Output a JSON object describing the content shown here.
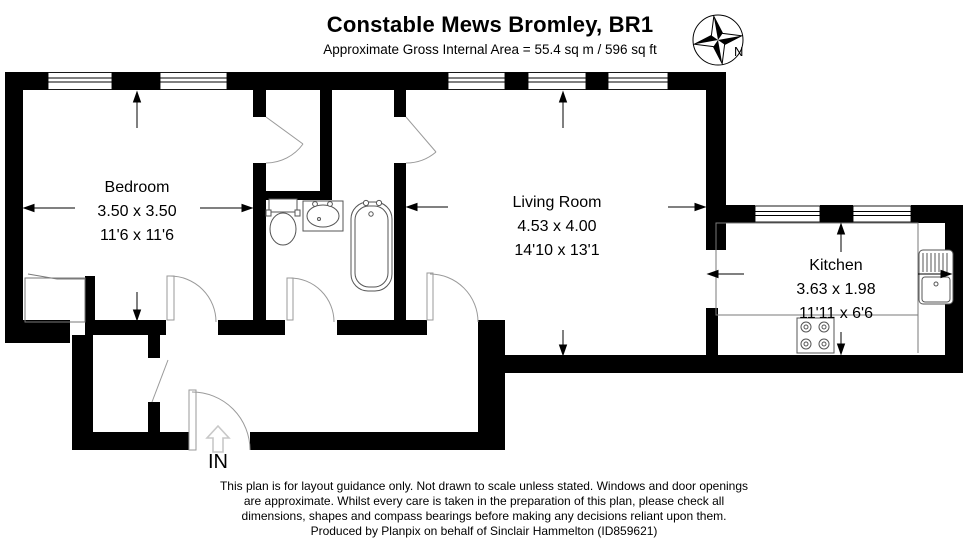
{
  "header": {
    "title": "Constable Mews Bromley, BR1",
    "subtitle": "Approximate Gross Internal Area = 55.4 sq m / 596 sq ft"
  },
  "compass": {
    "label": "N"
  },
  "entrance": {
    "label": "IN"
  },
  "rooms": {
    "bedroom": {
      "name": "Bedroom",
      "metric": "3.50 x 3.50",
      "imperial": "11'6 x 11'6"
    },
    "living_room": {
      "name": "Living Room",
      "metric": "4.53 x 4.00",
      "imperial": "14'10 x 13'1"
    },
    "kitchen": {
      "name": "Kitchen",
      "metric": "3.63 x 1.98",
      "imperial": "11'11 x 6'6"
    }
  },
  "fixtures": [
    "toilet",
    "sink",
    "bathtub",
    "kitchen-sink",
    "hob",
    "closet"
  ],
  "footer": {
    "lines": [
      "This plan is for layout guidance only. Not drawn to scale unless stated. Windows and door openings",
      "are approximate. Whilst every care is taken in the preparation of this plan, please check all",
      "dimensions, shapes and compass bearings before making any decisions reliant upon them.",
      "Produced by Planpix on behalf of Sinclair Hammelton (ID859621)"
    ]
  },
  "colors": {
    "wall": "#000000",
    "background": "#ffffff",
    "thin_line": "#7a7a7a",
    "door_line": "#9a9a9a",
    "entrance_arrow": "#c8c8c8"
  }
}
